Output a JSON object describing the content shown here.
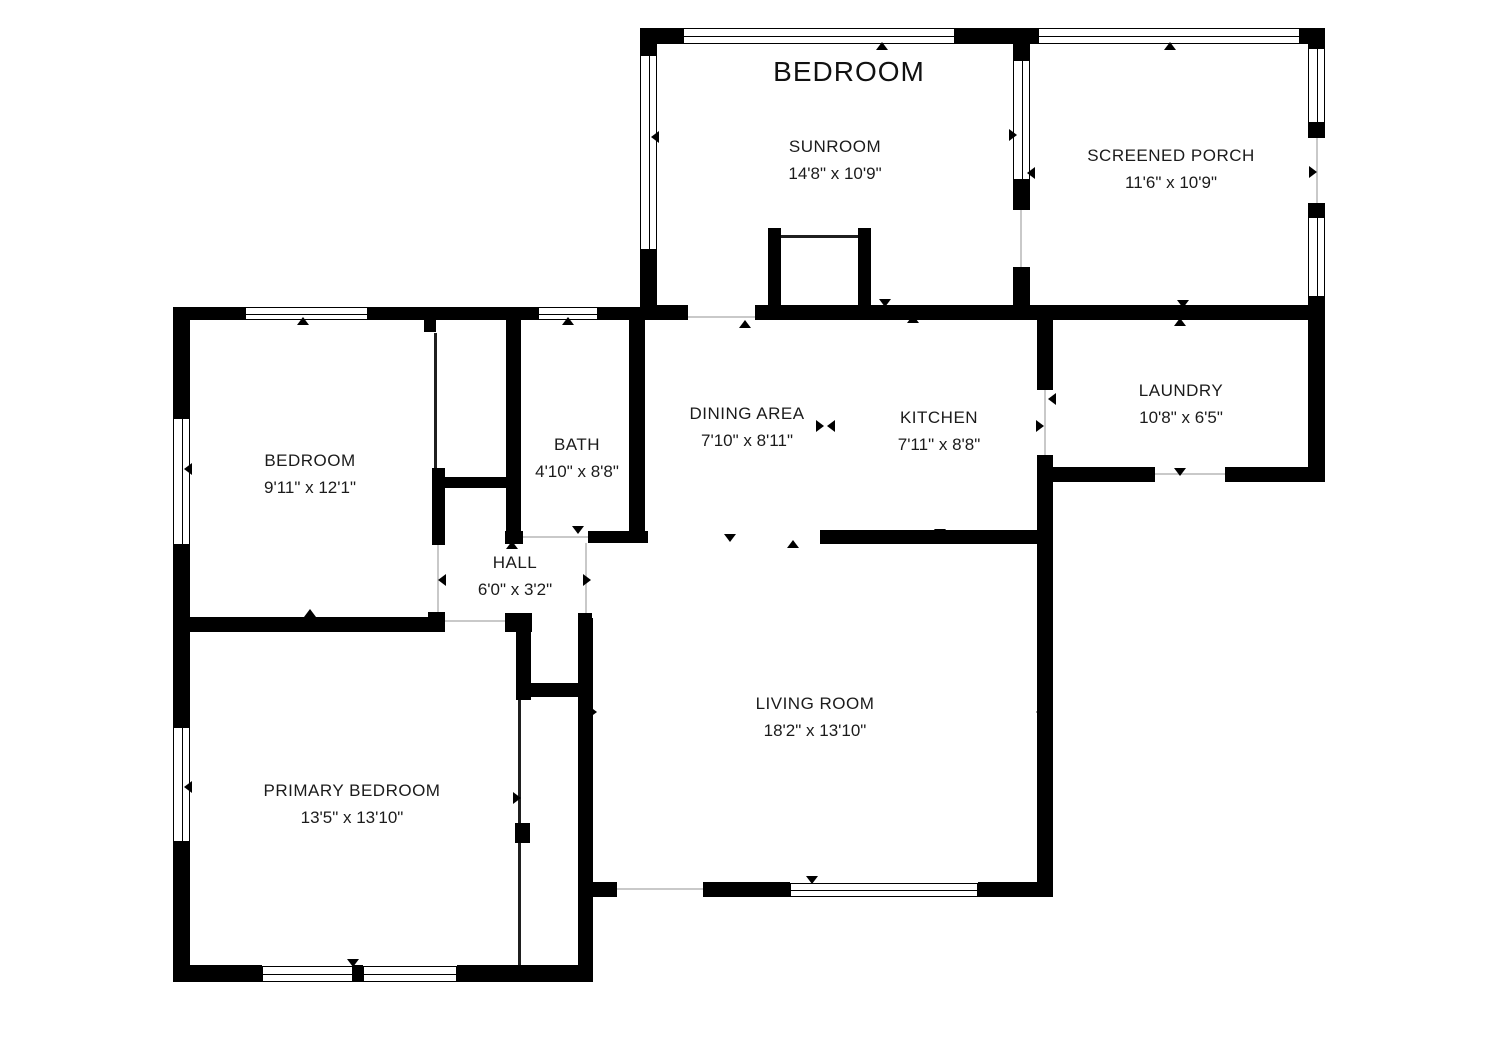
{
  "header_label": {
    "text": "BEDROOM"
  },
  "rooms": [
    {
      "id": "sunroom",
      "name": "SUNROOM",
      "dims": "14'8\" x 10'9\"",
      "cx": 835,
      "cy": 160
    },
    {
      "id": "screened-porch",
      "name": "SCREENED PORCH",
      "dims": "11'6\" x 10'9\"",
      "cx": 1171,
      "cy": 169
    },
    {
      "id": "bedroom",
      "name": "BEDROOM",
      "dims": "9'11\" x 12'1\"",
      "cx": 310,
      "cy": 474
    },
    {
      "id": "bath",
      "name": "BATH",
      "dims": "4'10\" x 8'8\"",
      "cx": 577,
      "cy": 458
    },
    {
      "id": "dining-area",
      "name": "DINING AREA",
      "dims": "7'10\" x 8'11\"",
      "cx": 747,
      "cy": 427
    },
    {
      "id": "kitchen",
      "name": "KITCHEN",
      "dims": "7'11\" x 8'8\"",
      "cx": 939,
      "cy": 431
    },
    {
      "id": "laundry",
      "name": "LAUNDRY",
      "dims": "10'8\" x 6'5\"",
      "cx": 1181,
      "cy": 404
    },
    {
      "id": "hall",
      "name": "HALL",
      "dims": "6'0\" x 3'2\"",
      "cx": 515,
      "cy": 576
    },
    {
      "id": "living-room",
      "name": "LIVING ROOM",
      "dims": "18'2\" x 13'10\"",
      "cx": 815,
      "cy": 717
    },
    {
      "id": "primary-bedroom",
      "name": "PRIMARY BEDROOM",
      "dims": "13'5\" x 13'10\"",
      "cx": 352,
      "cy": 804
    }
  ],
  "floorplan": {
    "canvas": {
      "w": 1500,
      "h": 1064
    },
    "colors": {
      "wall": "#000000",
      "text": "#1b1b1b",
      "threshold": "#c9c9c9",
      "background": "#ffffff"
    },
    "walls": [
      [
        640,
        28,
        17,
        292
      ],
      [
        640,
        28,
        390,
        16
      ],
      [
        1030,
        28,
        295,
        16
      ],
      [
        1013,
        28,
        17,
        32
      ],
      [
        1013,
        180,
        17,
        30
      ],
      [
        1013,
        267,
        17,
        53
      ],
      [
        1308,
        28,
        17,
        20
      ],
      [
        1308,
        123,
        17,
        15
      ],
      [
        1308,
        203,
        17,
        14
      ],
      [
        1308,
        297,
        17,
        23
      ],
      [
        1030,
        305,
        295,
        15
      ],
      [
        1013,
        305,
        40,
        15
      ],
      [
        657,
        305,
        31,
        15
      ],
      [
        755,
        305,
        258,
        15
      ],
      [
        768,
        228,
        13,
        77
      ],
      [
        858,
        228,
        13,
        77
      ],
      [
        948,
        29,
        4,
        14
      ],
      [
        1119,
        29,
        4,
        14
      ],
      [
        1211,
        29,
        4,
        14
      ],
      [
        173,
        307,
        72,
        13
      ],
      [
        368,
        307,
        170,
        13
      ],
      [
        598,
        307,
        47,
        13
      ],
      [
        173,
        307,
        17,
        111
      ],
      [
        173,
        545,
        17,
        182
      ],
      [
        173,
        842,
        17,
        138
      ],
      [
        424,
        318,
        12,
        14
      ],
      [
        506,
        318,
        15,
        225
      ],
      [
        629,
        318,
        16,
        225
      ],
      [
        505,
        531,
        18,
        13
      ],
      [
        588,
        531,
        60,
        12
      ],
      [
        432,
        468,
        13,
        77
      ],
      [
        433,
        477,
        79,
        11
      ],
      [
        173,
        617,
        272,
        15
      ],
      [
        428,
        612,
        17,
        20
      ],
      [
        505,
        613,
        27,
        19
      ],
      [
        578,
        613,
        14,
        19
      ],
      [
        516,
        618,
        15,
        82
      ],
      [
        530,
        683,
        50,
        14
      ],
      [
        578,
        618,
        15,
        362
      ],
      [
        515,
        823,
        15,
        20
      ],
      [
        173,
        965,
        89,
        17
      ],
      [
        353,
        965,
        10,
        17
      ],
      [
        457,
        965,
        136,
        17
      ],
      [
        593,
        882,
        24,
        15
      ],
      [
        703,
        882,
        87,
        15
      ],
      [
        978,
        882,
        75,
        15
      ],
      [
        820,
        530,
        219,
        14
      ],
      [
        1037,
        308,
        16,
        82
      ],
      [
        1037,
        455,
        16,
        442
      ],
      [
        1050,
        467,
        105,
        15
      ],
      [
        1225,
        467,
        100,
        15
      ],
      [
        1308,
        320,
        17,
        162
      ]
    ],
    "windows": [
      [
        683,
        28,
        272,
        16,
        "h"
      ],
      [
        1038,
        28,
        262,
        16,
        "h"
      ],
      [
        245,
        307,
        123,
        13,
        "h"
      ],
      [
        538,
        307,
        60,
        13,
        "h"
      ],
      [
        262,
        966,
        91,
        16,
        "h"
      ],
      [
        363,
        966,
        94,
        16,
        "h"
      ],
      [
        790,
        883,
        188,
        14,
        "h"
      ],
      [
        640,
        55,
        17,
        195,
        "v"
      ],
      [
        1013,
        60,
        17,
        120,
        "v"
      ],
      [
        1308,
        48,
        17,
        75,
        "v"
      ],
      [
        1308,
        217,
        17,
        80,
        "v"
      ],
      [
        173,
        418,
        17,
        127,
        "v"
      ],
      [
        173,
        727,
        17,
        115,
        "v"
      ]
    ],
    "thin_walls": [
      [
        434,
        333,
        3,
        135
      ],
      [
        518,
        700,
        3,
        123
      ],
      [
        518,
        843,
        3,
        122
      ],
      [
        781,
        235,
        77,
        3
      ]
    ],
    "thresholds": [
      [
        688,
        316,
        67,
        2
      ],
      [
        523,
        536,
        65,
        2
      ],
      [
        445,
        620,
        60,
        2
      ],
      [
        1155,
        473,
        70,
        2
      ],
      [
        617,
        888,
        86,
        2
      ],
      [
        1020,
        210,
        2,
        57
      ],
      [
        1044,
        390,
        2,
        65
      ],
      [
        437,
        545,
        2,
        67
      ],
      [
        585,
        543,
        2,
        70
      ],
      [
        1316,
        138,
        2,
        65
      ]
    ],
    "arrows": [
      [
        882,
        46,
        "up"
      ],
      [
        1170,
        46,
        "up"
      ],
      [
        655,
        137,
        "left"
      ],
      [
        1013,
        135,
        "right"
      ],
      [
        1031,
        173,
        "left"
      ],
      [
        1313,
        172,
        "right"
      ],
      [
        1183,
        304,
        "down"
      ],
      [
        885,
        303,
        "down"
      ],
      [
        745,
        324,
        "up"
      ],
      [
        913,
        319,
        "up"
      ],
      [
        1180,
        322,
        "up"
      ],
      [
        303,
        321,
        "up"
      ],
      [
        568,
        321,
        "up"
      ],
      [
        188,
        469,
        "left"
      ],
      [
        188,
        787,
        "left"
      ],
      [
        310,
        613,
        "up"
      ],
      [
        352,
        626,
        "down"
      ],
      [
        578,
        530,
        "down"
      ],
      [
        512,
        545,
        "up"
      ],
      [
        442,
        580,
        "left"
      ],
      [
        587,
        580,
        "right"
      ],
      [
        513,
        617,
        "down"
      ],
      [
        820,
        426,
        "right"
      ],
      [
        831,
        426,
        "left"
      ],
      [
        1052,
        399,
        "left"
      ],
      [
        1040,
        426,
        "right"
      ],
      [
        1315,
        398,
        "right"
      ],
      [
        1180,
        472,
        "down"
      ],
      [
        940,
        533,
        "down"
      ],
      [
        730,
        538,
        "down"
      ],
      [
        793,
        544,
        "up"
      ],
      [
        593,
        712,
        "right"
      ],
      [
        1040,
        712,
        "left"
      ],
      [
        812,
        880,
        "down"
      ],
      [
        353,
        963,
        "down"
      ],
      [
        517,
        798,
        "right"
      ]
    ]
  }
}
